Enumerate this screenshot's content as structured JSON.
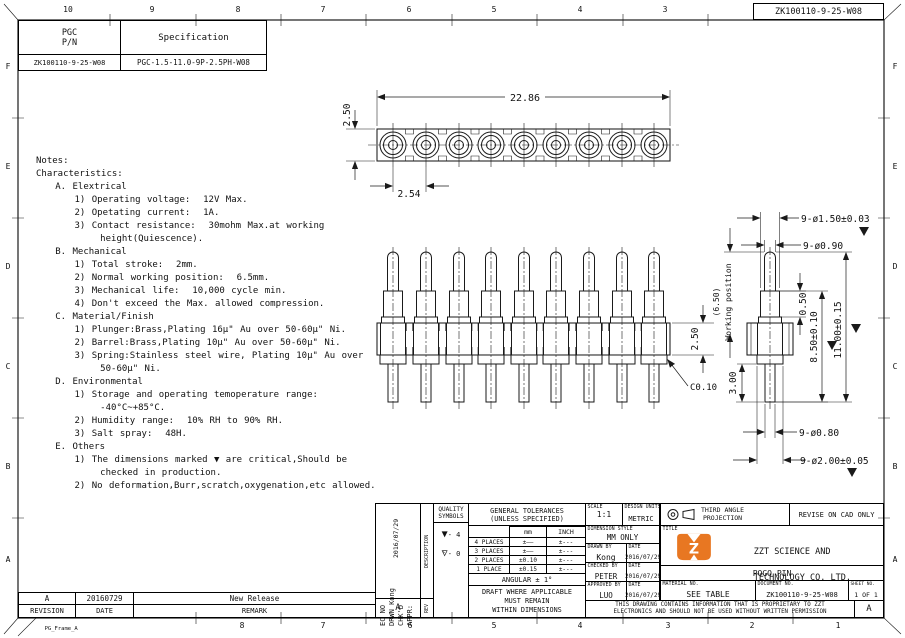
{
  "doc_number": "ZK100110-9-25-W08",
  "frame": {
    "name": "PG_Frame_A",
    "rev": "rev. A  2015/05/01"
  },
  "zones": {
    "top": [
      "10",
      "9",
      "8",
      "7",
      "6",
      "5",
      "4",
      "3"
    ],
    "bottom": [
      "8",
      "7",
      "6",
      "5",
      "4",
      "3",
      "2",
      "1"
    ],
    "left": [
      "F",
      "E",
      "D",
      "C",
      "B",
      "A"
    ],
    "right": [
      "F",
      "E",
      "D",
      "C",
      "B",
      "A"
    ]
  },
  "part_table": {
    "h_pn_1": "PGC",
    "h_pn_2": "P/N",
    "h_spec": "Specification",
    "pn": "ZK100110-9-25-W08",
    "spec": "PGC-1.5-11.0-9P-2.5PH-W08"
  },
  "notes": {
    "text": "Notes:\nCharacteristics:\n   A. Elextrical\n      1) Operating voltage:  12V Max.\n      2) Opetating current:  1A.\n      3) Contact resistance:  30mohm Max.at working\n          height(Quiescence).\n   B. Mechanical\n      1) Total stroke:  2mm.\n      2) Normal working position:  6.5mm.\n      3) Mechanical life:  10,000 cycle min.\n      4) Don't exceed the Max. allowed compression.\n   C. Material/Finish\n      1) Plunger:Brass,Plating 16µ\" Au over 50-60µ\" Ni.\n      2) Barrel:Brass,Plating 10µ\" Au over 50-60µ\" Ni.\n      3) Spring:Stainless steel wire, Plating 10µ\" Au over\n          50-60µ\" Ni.\n   D. Environmental\n      1) Storage and operating temoperature range:\n          -40°C~+85°C.\n      2) Humidity range:  10% RH to 90% RH.\n      3) Salt spray:  48H.\n   E. Others\n      1) The dimensions marked ▼ are critical,Should be\n          checked in production.\n      2) No deformation,Burr,scratch,oxygenation,etc allowed."
  },
  "dims": {
    "top_overall": "22.86",
    "top_height": "2.50",
    "top_pitch": "2.54",
    "side_height": "2.50",
    "side_chamfer": "C0.10",
    "tip_dia": "9-ø1.50±0.03",
    "plunger_dia": "9-ø0.90",
    "working_value": "(6.50)",
    "working_label": "Working position",
    "lip": "0.50",
    "barrel_len": "8.50±0.10",
    "total_len": "11.00±0.15",
    "tail_len": "3.00",
    "tail_dia": "9-ø0.80",
    "base_dia": "9-ø2.00±0.05"
  },
  "title_block": {
    "ec": {
      "lines": "EC NO\nDRWN Kong\nCHK'D\nAPPR:",
      "date": "2016/07/29",
      "rev": "A",
      "description": "DESCRIPTION",
      "rev_label": "REV"
    },
    "quality": {
      "l1": "QUALITY",
      "l2": "SYMBOLS",
      "s1": "- 4",
      "s2": "- 0"
    },
    "tol": {
      "t1": "GENERAL TOLERANCES",
      "t2": "(UNLESS SPECIFIED)",
      "mm": "mm",
      "inch": "INCH",
      "r1l": "4 PLACES",
      "r1m": "±——",
      "r1i": "±---",
      "r2l": "3 PLACES",
      "r2m": "±——",
      "r2i": "±---",
      "r3l": "2 PLACES",
      "r3m": "±0.10",
      "r3i": "±---",
      "r4l": "1 PLACE",
      "r4m": "±0.15",
      "r4i": "±---",
      "angular": "ANGULAR ± 1°",
      "d1": "DRAFT WHERE APPLICABLE",
      "d2": "MUST REMAIN",
      "d3": "WITHIN DIMENSIONS"
    },
    "info": {
      "scale_l": "SCALE",
      "scale": "1:1",
      "units_l": "DESIGN UNITS",
      "units": "METRIC",
      "style_l": "DIMENSION STYLE",
      "style": "MM ONLY",
      "drawn_l": "DRAWN BY",
      "drawn": "Kong",
      "checked_l": "CHECKED BY",
      "checked": "PETER",
      "approved_l": "APPROVED BY",
      "approved": "LUO",
      "date_l": "DATE",
      "date": "2016/07/29"
    },
    "proj": {
      "l1": "THIRD ANGLE",
      "l2": "PROJECTION",
      "revise": "REVISE ON CAD ONLY"
    },
    "company": {
      "title_l": "TITLE",
      "n1": "ZZT SCIENCE AND",
      "n2": "TECHNOLOGY CO. LTD.",
      "product": "POGO PIN"
    },
    "docs": {
      "mat_l": "MATERIAL NO.",
      "mat": "SEE TABLE",
      "doc_l": "DOCUMENT NO.",
      "doc": "ZK100110-9-25-W08",
      "sheet_l": "SHEET NO.",
      "sheet": "1 OF 1",
      "p1": "THIS DRAWING CONTAINS INFORMATION THAT IS PROPRIETARY TO ZZT",
      "p2": "ELECTRONICS AND SHOULD NOT BE USED WITHOUT WRITTEN PERMISSION",
      "rev": "A"
    }
  },
  "revision_table": {
    "rev": "A",
    "date": "20160729",
    "remark": "New Release",
    "h_rev": "REVISION",
    "h_date": "DATE",
    "h_remark": "REMARK"
  },
  "brand": {
    "logo_color": "#e87722"
  }
}
